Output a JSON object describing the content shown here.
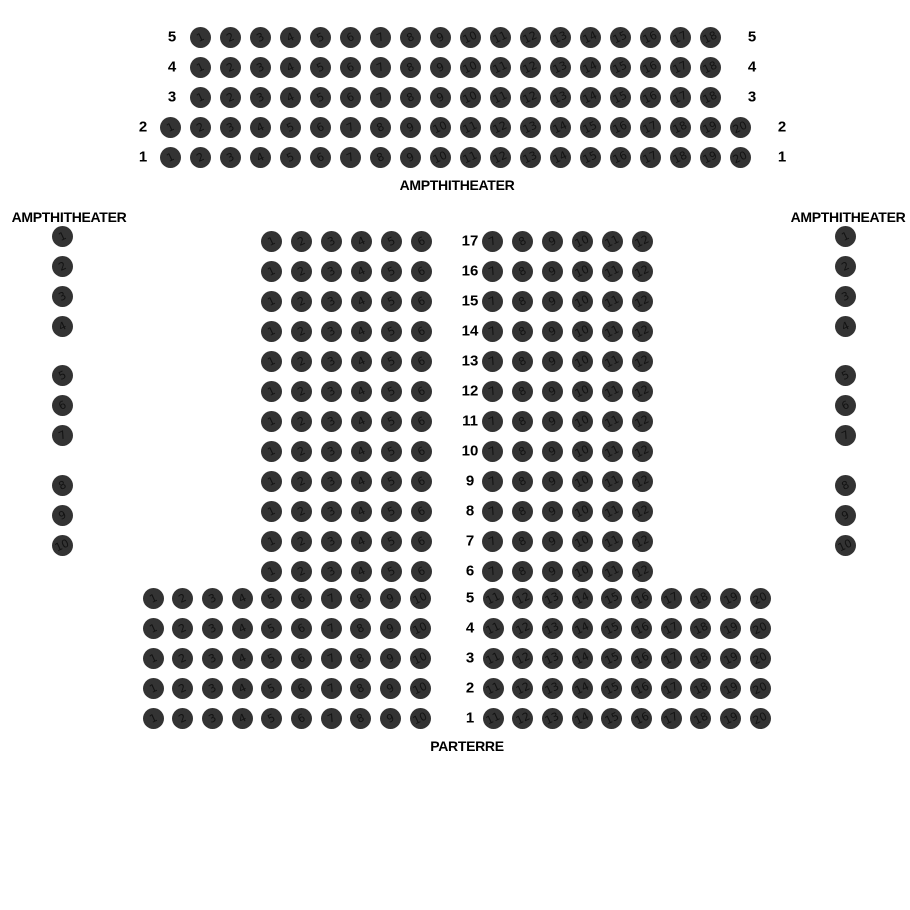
{
  "canvas": {
    "width": 910,
    "height": 910,
    "background": "#ffffff"
  },
  "seat_style": {
    "diameter": 21,
    "color": "#333333",
    "number_color": "#0a0a0a",
    "number_rotation_deg": -25
  },
  "sections": {
    "amphitheater_top": {
      "label": "AMPTHITHEATER",
      "rows": [
        {
          "label": "5",
          "y": 37,
          "left_label_x": 172,
          "right_label_x": 752,
          "groups": [
            {
              "x": 200,
              "spacing": 30,
              "numbers": [
                1,
                2,
                3,
                4,
                5,
                6,
                7,
                8,
                9,
                10,
                11,
                12,
                13,
                14,
                15,
                16,
                17,
                18
              ]
            }
          ]
        },
        {
          "label": "4",
          "y": 67,
          "left_label_x": 172,
          "right_label_x": 752,
          "groups": [
            {
              "x": 200,
              "spacing": 30,
              "numbers": [
                1,
                2,
                3,
                4,
                5,
                6,
                7,
                8,
                9,
                10,
                11,
                12,
                13,
                14,
                15,
                16,
                17,
                18
              ]
            }
          ]
        },
        {
          "label": "3",
          "y": 97,
          "left_label_x": 172,
          "right_label_x": 752,
          "groups": [
            {
              "x": 200,
              "spacing": 30,
              "numbers": [
                1,
                2,
                3,
                4,
                5,
                6,
                7,
                8,
                9,
                10,
                11,
                12,
                13,
                14,
                15,
                16,
                17,
                18
              ]
            }
          ]
        },
        {
          "label": "2",
          "y": 127,
          "left_label_x": 143,
          "right_label_x": 782,
          "groups": [
            {
              "x": 170,
              "spacing": 30,
              "numbers": [
                1,
                2,
                3,
                4,
                5,
                6,
                7,
                8,
                9,
                10,
                11,
                12,
                13,
                14,
                15,
                16,
                17,
                18,
                19,
                20
              ]
            }
          ]
        },
        {
          "label": "1",
          "y": 157,
          "left_label_x": 143,
          "right_label_x": 782,
          "groups": [
            {
              "x": 170,
              "spacing": 30,
              "numbers": [
                1,
                2,
                3,
                4,
                5,
                6,
                7,
                8,
                9,
                10,
                11,
                12,
                13,
                14,
                15,
                16,
                17,
                18,
                19,
                20
              ]
            }
          ]
        }
      ]
    },
    "amphitheater_left": {
      "label": "AMPTHITHEATER",
      "x": 62,
      "spacing": 30,
      "groups": [
        {
          "y": 236,
          "numbers": [
            1,
            2,
            3,
            4
          ]
        },
        {
          "y": 375,
          "numbers": [
            5,
            6,
            7
          ]
        },
        {
          "y": 485,
          "numbers": [
            8,
            9,
            10
          ]
        }
      ]
    },
    "amphitheater_right": {
      "label": "AMPTHITHEATER",
      "x": 845,
      "spacing": 30,
      "groups": [
        {
          "y": 236,
          "numbers": [
            1,
            2,
            3,
            4
          ]
        },
        {
          "y": 375,
          "numbers": [
            5,
            6,
            7
          ]
        },
        {
          "y": 485,
          "numbers": [
            8,
            9,
            10
          ]
        }
      ]
    },
    "parterre": {
      "label": "PARTERRE",
      "row_label_x": 470,
      "rows": [
        {
          "label": "17",
          "y": 241,
          "groups": [
            {
              "x": 271,
              "spacing": 30,
              "numbers": [
                1,
                2,
                3,
                4,
                5,
                6
              ]
            },
            {
              "x": 492,
              "spacing": 30,
              "numbers": [
                7,
                8,
                9,
                10,
                11,
                12
              ]
            }
          ]
        },
        {
          "label": "16",
          "y": 271,
          "groups": [
            {
              "x": 271,
              "spacing": 30,
              "numbers": [
                1,
                2,
                3,
                4,
                5,
                6
              ]
            },
            {
              "x": 492,
              "spacing": 30,
              "numbers": [
                7,
                8,
                9,
                10,
                11,
                12
              ]
            }
          ]
        },
        {
          "label": "15",
          "y": 301,
          "groups": [
            {
              "x": 271,
              "spacing": 30,
              "numbers": [
                1,
                2,
                3,
                4,
                5,
                6
              ]
            },
            {
              "x": 492,
              "spacing": 30,
              "numbers": [
                7,
                8,
                9,
                10,
                11,
                12
              ]
            }
          ]
        },
        {
          "label": "14",
          "y": 331,
          "groups": [
            {
              "x": 271,
              "spacing": 30,
              "numbers": [
                1,
                2,
                3,
                4,
                5,
                6
              ]
            },
            {
              "x": 492,
              "spacing": 30,
              "numbers": [
                7,
                8,
                9,
                10,
                11,
                12
              ]
            }
          ]
        },
        {
          "label": "13",
          "y": 361,
          "groups": [
            {
              "x": 271,
              "spacing": 30,
              "numbers": [
                1,
                2,
                3,
                4,
                5,
                6
              ]
            },
            {
              "x": 492,
              "spacing": 30,
              "numbers": [
                7,
                8,
                9,
                10,
                11,
                12
              ]
            }
          ]
        },
        {
          "label": "12",
          "y": 391,
          "groups": [
            {
              "x": 271,
              "spacing": 30,
              "numbers": [
                1,
                2,
                3,
                4,
                5,
                6
              ]
            },
            {
              "x": 492,
              "spacing": 30,
              "numbers": [
                7,
                8,
                9,
                10,
                11,
                12
              ]
            }
          ]
        },
        {
          "label": "11",
          "y": 421,
          "groups": [
            {
              "x": 271,
              "spacing": 30,
              "numbers": [
                1,
                2,
                3,
                4,
                5,
                6
              ]
            },
            {
              "x": 492,
              "spacing": 30,
              "numbers": [
                7,
                8,
                9,
                10,
                11,
                12
              ]
            }
          ]
        },
        {
          "label": "10",
          "y": 451,
          "groups": [
            {
              "x": 271,
              "spacing": 30,
              "numbers": [
                1,
                2,
                3,
                4,
                5,
                6
              ]
            },
            {
              "x": 492,
              "spacing": 30,
              "numbers": [
                7,
                8,
                9,
                10,
                11,
                12
              ]
            }
          ]
        },
        {
          "label": "9",
          "y": 481,
          "groups": [
            {
              "x": 271,
              "spacing": 30,
              "numbers": [
                1,
                2,
                3,
                4,
                5,
                6
              ]
            },
            {
              "x": 492,
              "spacing": 30,
              "numbers": [
                7,
                8,
                9,
                10,
                11,
                12
              ]
            }
          ]
        },
        {
          "label": "8",
          "y": 511,
          "groups": [
            {
              "x": 271,
              "spacing": 30,
              "numbers": [
                1,
                2,
                3,
                4,
                5,
                6
              ]
            },
            {
              "x": 492,
              "spacing": 30,
              "numbers": [
                7,
                8,
                9,
                10,
                11,
                12
              ]
            }
          ]
        },
        {
          "label": "7",
          "y": 541,
          "groups": [
            {
              "x": 271,
              "spacing": 30,
              "numbers": [
                1,
                2,
                3,
                4,
                5,
                6
              ]
            },
            {
              "x": 492,
              "spacing": 30,
              "numbers": [
                7,
                8,
                9,
                10,
                11,
                12
              ]
            }
          ]
        },
        {
          "label": "6",
          "y": 571,
          "groups": [
            {
              "x": 271,
              "spacing": 30,
              "numbers": [
                1,
                2,
                3,
                4,
                5,
                6
              ]
            },
            {
              "x": 492,
              "spacing": 30,
              "numbers": [
                7,
                8,
                9,
                10,
                11,
                12
              ]
            }
          ]
        },
        {
          "label": "5",
          "y": 598,
          "groups": [
            {
              "x": 153,
              "spacing": 29.7,
              "numbers": [
                1,
                2,
                3,
                4,
                5,
                6,
                7,
                8,
                9,
                10
              ]
            },
            {
              "x": 493,
              "spacing": 29.7,
              "numbers": [
                11,
                12,
                13,
                14,
                15,
                16,
                17,
                18,
                19,
                20
              ]
            }
          ]
        },
        {
          "label": "4",
          "y": 628,
          "groups": [
            {
              "x": 153,
              "spacing": 29.7,
              "numbers": [
                1,
                2,
                3,
                4,
                5,
                6,
                7,
                8,
                9,
                10
              ]
            },
            {
              "x": 493,
              "spacing": 29.7,
              "numbers": [
                11,
                12,
                13,
                14,
                15,
                16,
                17,
                18,
                19,
                20
              ]
            }
          ]
        },
        {
          "label": "3",
          "y": 658,
          "groups": [
            {
              "x": 153,
              "spacing": 29.7,
              "numbers": [
                1,
                2,
                3,
                4,
                5,
                6,
                7,
                8,
                9,
                10
              ]
            },
            {
              "x": 493,
              "spacing": 29.7,
              "numbers": [
                11,
                12,
                13,
                14,
                15,
                16,
                17,
                18,
                19,
                20
              ]
            }
          ]
        },
        {
          "label": "2",
          "y": 688,
          "groups": [
            {
              "x": 153,
              "spacing": 29.7,
              "numbers": [
                1,
                2,
                3,
                4,
                5,
                6,
                7,
                8,
                9,
                10
              ]
            },
            {
              "x": 493,
              "spacing": 29.7,
              "numbers": [
                11,
                12,
                13,
                14,
                15,
                16,
                17,
                18,
                19,
                20
              ]
            }
          ]
        },
        {
          "label": "1",
          "y": 718,
          "groups": [
            {
              "x": 153,
              "spacing": 29.7,
              "numbers": [
                1,
                2,
                3,
                4,
                5,
                6,
                7,
                8,
                9,
                10
              ]
            },
            {
              "x": 493,
              "spacing": 29.7,
              "numbers": [
                11,
                12,
                13,
                14,
                15,
                16,
                17,
                18,
                19,
                20
              ]
            }
          ]
        }
      ]
    }
  }
}
